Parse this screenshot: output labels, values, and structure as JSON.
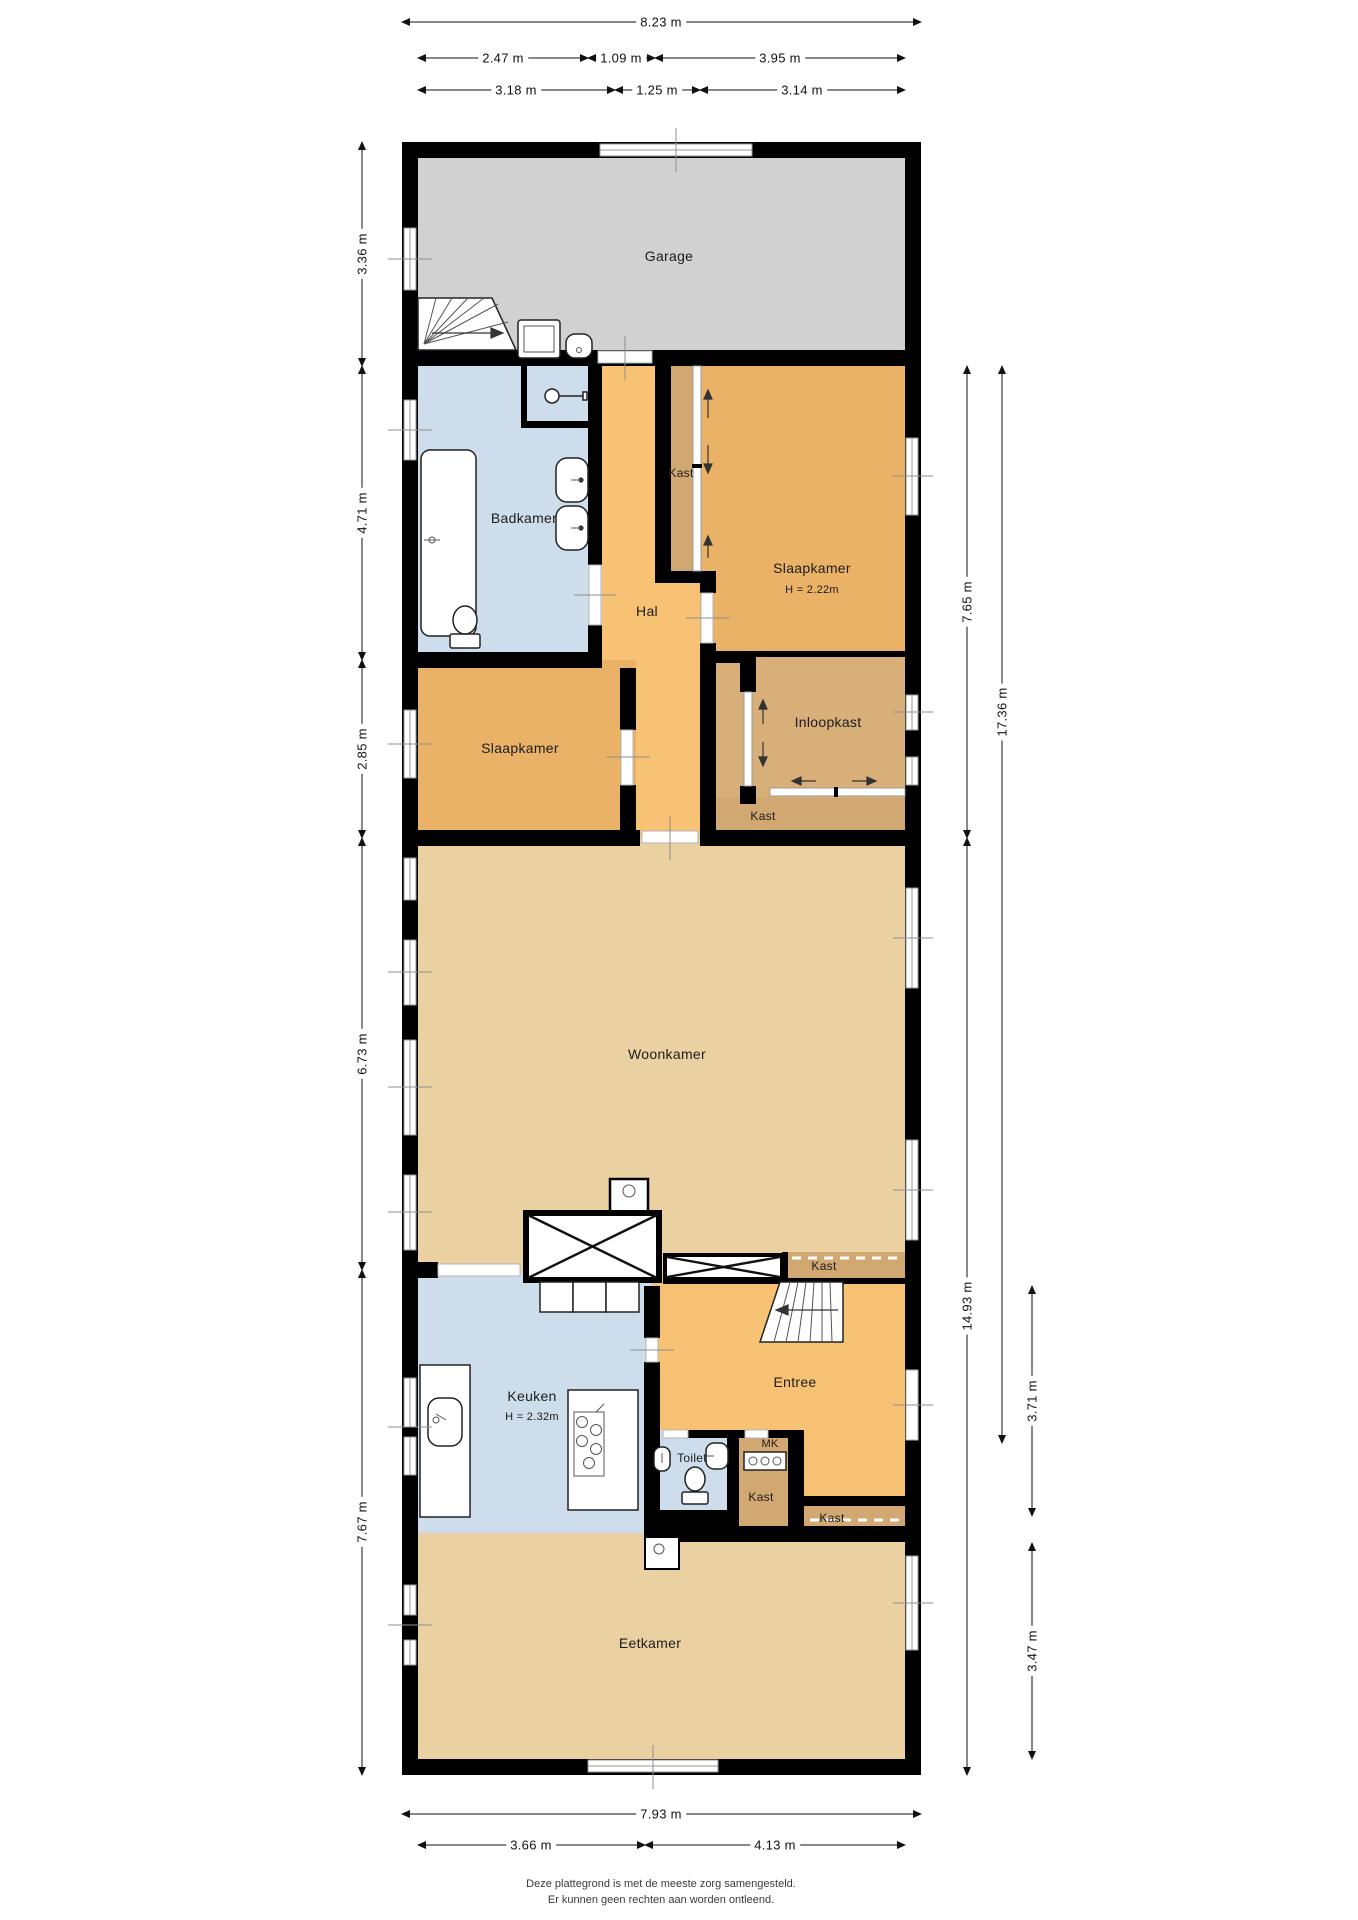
{
  "rooms": {
    "garage": {
      "label": "Garage"
    },
    "badkamer": {
      "label": "Badkamer"
    },
    "hal": {
      "label": "Hal"
    },
    "kast_hal": {
      "label": "Kast"
    },
    "slaapkamer_rechts": {
      "label": "Slaapkamer",
      "height_note": "H = 2.22m"
    },
    "inloopkast": {
      "label": "Inloopkast"
    },
    "kast_inloopkast": {
      "label": "Kast"
    },
    "slaapkamer_links": {
      "label": "Slaapkamer"
    },
    "woonkamer": {
      "label": "Woonkamer"
    },
    "kast_woonkamer": {
      "label": "Kast"
    },
    "keuken": {
      "label": "Keuken",
      "height_note": "H = 2.32m"
    },
    "entree": {
      "label": "Entree"
    },
    "toilet": {
      "label": "Toilet"
    },
    "mk": {
      "label": "MK"
    },
    "kast_entree": {
      "label": "Kast"
    },
    "kast_gang": {
      "label": "Kast"
    },
    "eetkamer": {
      "label": "Eetkamer"
    }
  },
  "dimensions": {
    "top": {
      "total": "8.23 m",
      "row2": [
        "2.47 m",
        "1.09 m",
        "3.95 m"
      ],
      "row3": [
        "3.18 m",
        "1.25 m",
        "3.14 m"
      ]
    },
    "left": [
      "3.36 m",
      "4.71 m",
      "2.85 m",
      "6.73 m",
      "7.67 m"
    ],
    "right": {
      "inner": [
        "7.65 m",
        "14.93 m"
      ],
      "outer": "17.36 m",
      "sections": [
        "3.71 m",
        "3.47 m"
      ]
    },
    "bottom": {
      "total": "7.93 m",
      "row2": [
        "3.66 m",
        "4.13 m"
      ]
    }
  },
  "disclaimer": {
    "line1": "Deze plattegrond is met de meeste zorg samengesteld.",
    "line2": "Er kunnen geen rechten aan worden ontleend."
  },
  "colors": {
    "garage": "#d1d1d1",
    "wet": "#cdddec",
    "hal": "#f7c273",
    "slaap": "#e9b266",
    "kast": "#d2a872",
    "ilk": "#d8af78",
    "leef": "#ebd1a2"
  }
}
